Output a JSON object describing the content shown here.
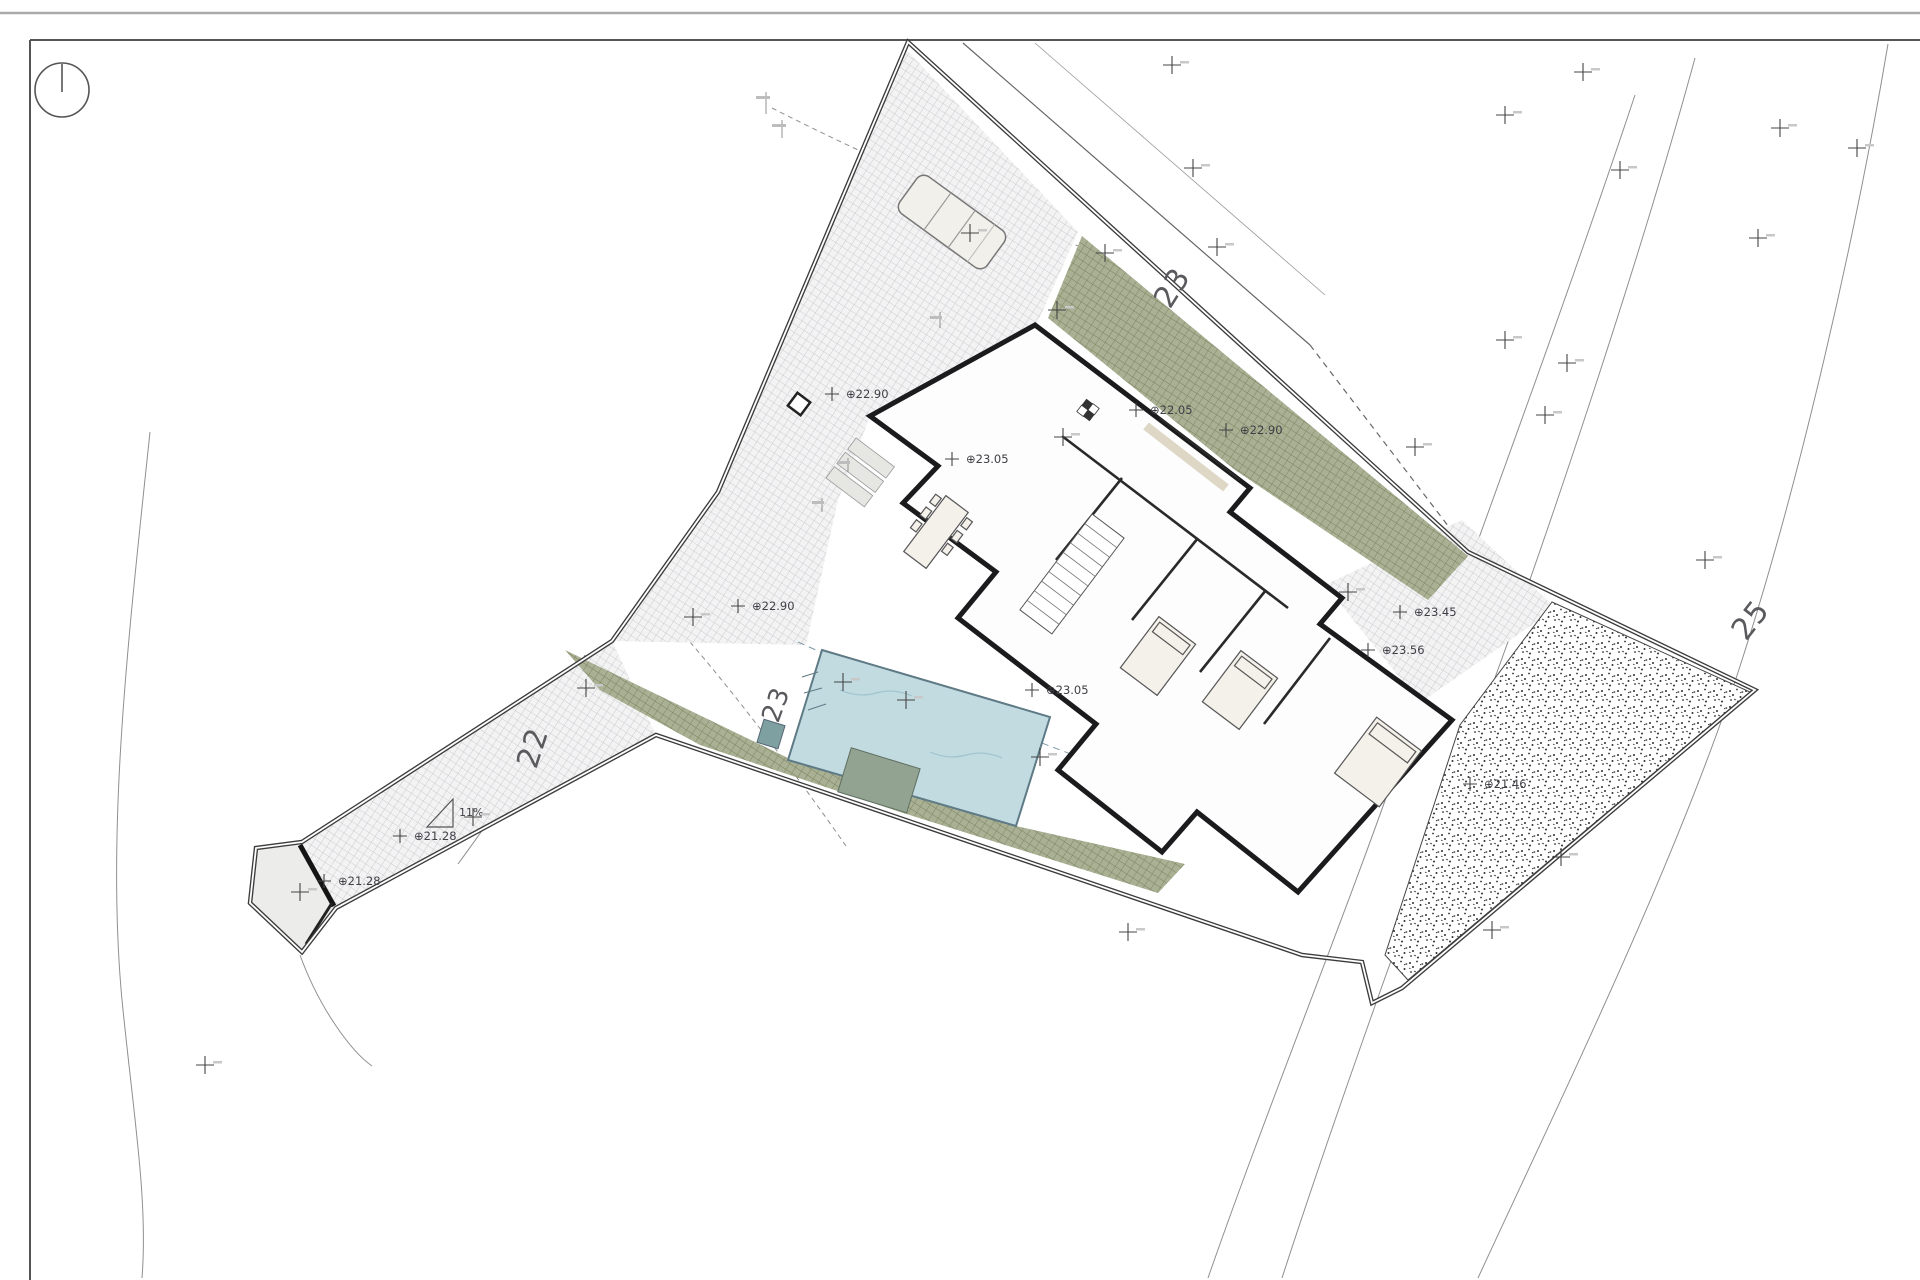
{
  "north_indicator": {
    "icon": "north-arrow-icon"
  },
  "colors": {
    "paper": "#ffffff",
    "pool_fill": "#c1dbe1",
    "pool_edge": "#5d7a85",
    "vegetation_fill": "#a9b093",
    "vegetation_hatch": "#7a8260",
    "gravel_hatch": "#c2c2c8",
    "wall_ink": "#1b1b1d",
    "contour_line": "#8f8f8f",
    "label_ink": "#3e3e45"
  },
  "elevation_labels": [
    {
      "text": "⊕22.90",
      "x": 846,
      "y": 398
    },
    {
      "text": "⊕23.05",
      "x": 966,
      "y": 463
    },
    {
      "text": "⊕22.05",
      "x": 1150,
      "y": 414
    },
    {
      "text": "⊕22.90",
      "x": 1240,
      "y": 434
    },
    {
      "text": "⊕22.90",
      "x": 752,
      "y": 610
    },
    {
      "text": "⊕23.05",
      "x": 1046,
      "y": 694
    },
    {
      "text": "⊕23.45",
      "x": 1414,
      "y": 616
    },
    {
      "text": "⊕23.56",
      "x": 1382,
      "y": 654
    },
    {
      "text": "⊕21.28",
      "x": 414,
      "y": 840
    },
    {
      "text": "⊕21.28",
      "x": 338,
      "y": 885
    },
    {
      "text": "⊕21.46",
      "x": 1484,
      "y": 788
    }
  ],
  "contour_labels": [
    {
      "text": "23",
      "x": 1170,
      "y": 310,
      "rot": -58,
      "size": 30
    },
    {
      "text": "25",
      "x": 1746,
      "y": 642,
      "rot": -52,
      "size": 30
    },
    {
      "text": "23",
      "x": 778,
      "y": 724,
      "rot": -70,
      "size": 26
    },
    {
      "text": "22",
      "x": 536,
      "y": 770,
      "rot": -72,
      "size": 30
    }
  ],
  "slope": {
    "label": "11%"
  },
  "survey_crosses": [
    [
      1172,
      65
    ],
    [
      1505,
      115
    ],
    [
      1583,
      72
    ],
    [
      1620,
      170
    ],
    [
      1193,
      168
    ],
    [
      1217,
      247
    ],
    [
      1505,
      340
    ],
    [
      1567,
      363
    ],
    [
      1545,
      415
    ],
    [
      1780,
      128
    ],
    [
      1857,
      148
    ],
    [
      1758,
      238
    ],
    [
      1705,
      560
    ],
    [
      1561,
      857
    ],
    [
      1492,
      930
    ],
    [
      970,
      233
    ],
    [
      1105,
      253
    ],
    [
      1063,
      437
    ],
    [
      1057,
      310
    ],
    [
      693,
      617
    ],
    [
      586,
      688
    ],
    [
      906,
      700
    ],
    [
      843,
      682
    ],
    [
      1040,
      757
    ],
    [
      1128,
      932
    ],
    [
      473,
      817
    ],
    [
      300,
      892
    ],
    [
      205,
      1065
    ],
    [
      1348,
      592
    ],
    [
      1415,
      447
    ]
  ]
}
